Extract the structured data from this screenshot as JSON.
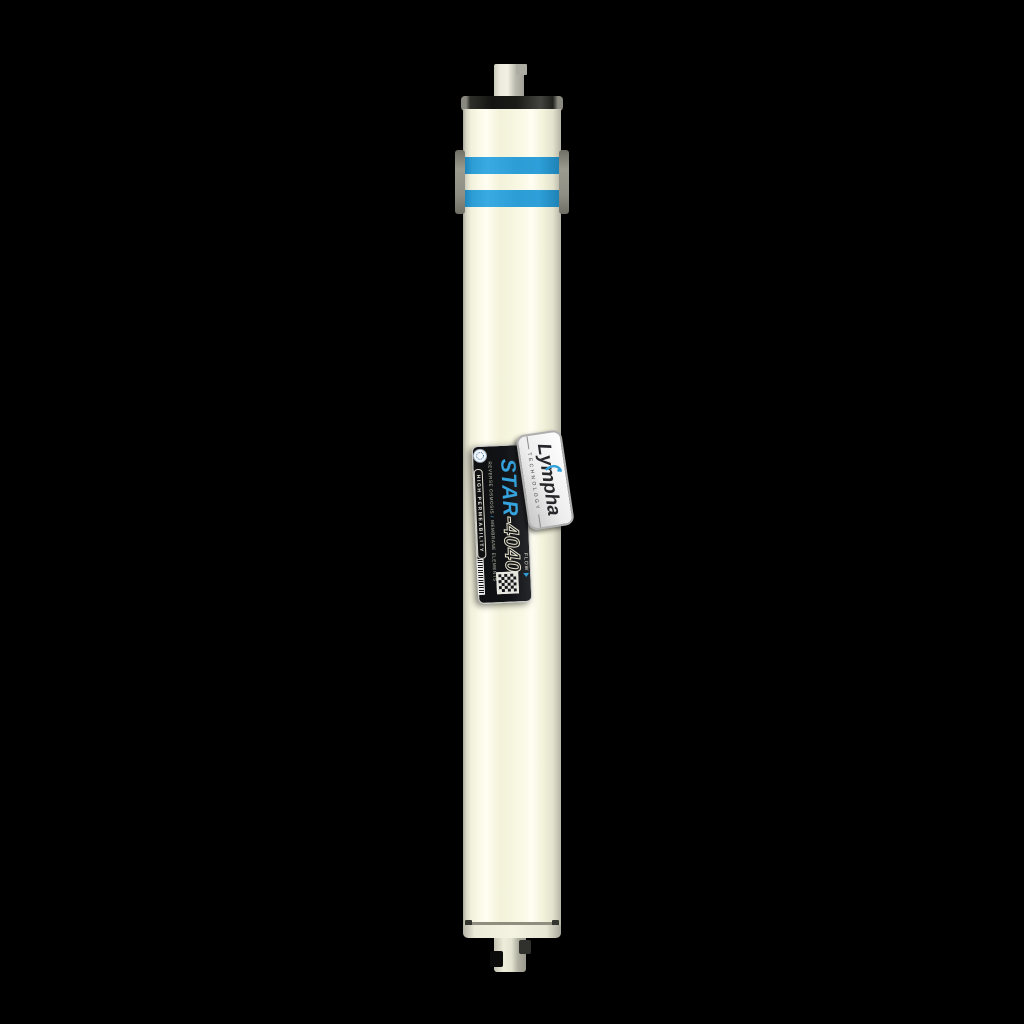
{
  "product": {
    "brand": "Lympha",
    "brand_tagline": "TECHNOLOGY",
    "model_name": "STAR",
    "model_number": "-4040",
    "subtitle_left": "REVERSE OSMOSIS",
    "subtitle_divider": "/",
    "subtitle_right": "MEMBRANE ELEMENTS",
    "feature_badge": "HIGH PERMEABILITY",
    "flow_label": "FLOW"
  },
  "colors": {
    "background": "#000000",
    "body_cream": "#f6f5df",
    "stripe_blue": "#2d9fd9",
    "accent_blue": "#35a4de",
    "label_dark": "#121316",
    "cap_dark": "#1b1b18",
    "metal_gray": "#9a9a90",
    "plate_silver": "#e9e9e9"
  }
}
